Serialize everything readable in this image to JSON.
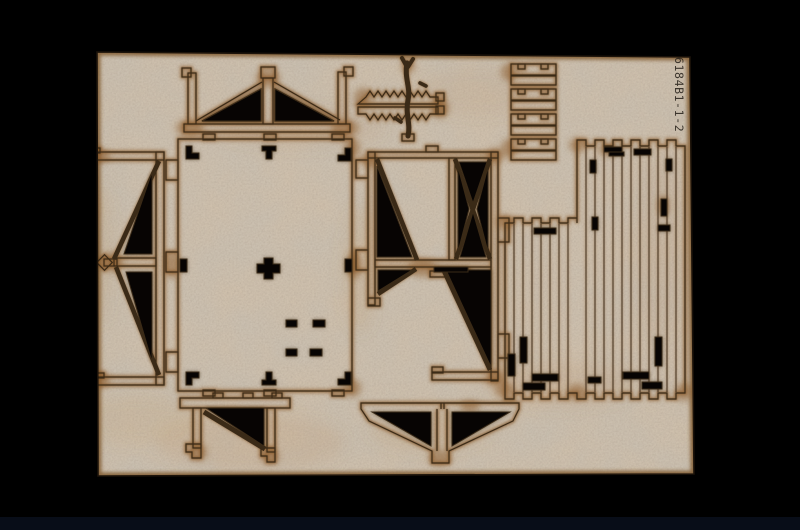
{
  "image": {
    "kind": "photograph of a laser-cut wooden parts sheet from a scale model kit on a black background",
    "sheet_code": "6184B1-1-2"
  },
  "colors": {
    "background": "#000000",
    "bottom_strip": "#0c1322",
    "board": "#c9bfb0",
    "board_light": "#d8cfc1",
    "warm_patch": "#b98f5f",
    "burn": "#8a5827",
    "burn_deep": "#603c16",
    "edge_burn": "#7a5328",
    "cut_line": "#3a2a17",
    "cutout": "#070403",
    "label_text": "#2a241d"
  },
  "parts": [
    {
      "id": "gable-roof-truss",
      "desc": "triangular roof truss with king post and end posts"
    },
    {
      "id": "foliage-frond",
      "desc": "horizontal herringbone frond piece"
    },
    {
      "id": "branch-twig",
      "desc": "curved forked twig piece"
    },
    {
      "id": "rung-slats",
      "desc": "four pairs of notched slats"
    },
    {
      "id": "wall-panel",
      "desc": "large rectangular wall panel with joint slots"
    },
    {
      "id": "cross-braced-frame",
      "desc": "frame panel with X-bracing and diagonals"
    },
    {
      "id": "planked-wall",
      "desc": "vertical planked wall with castellated edges and slots"
    },
    {
      "id": "side-truss",
      "desc": "sideways gable truss with finial hub"
    },
    {
      "id": "shelf-bracket",
      "desc": "bracket with diagonal brace and feet"
    },
    {
      "id": "double-knee-brace",
      "desc": "butterfly support with twin triangular cut-outs"
    }
  ]
}
